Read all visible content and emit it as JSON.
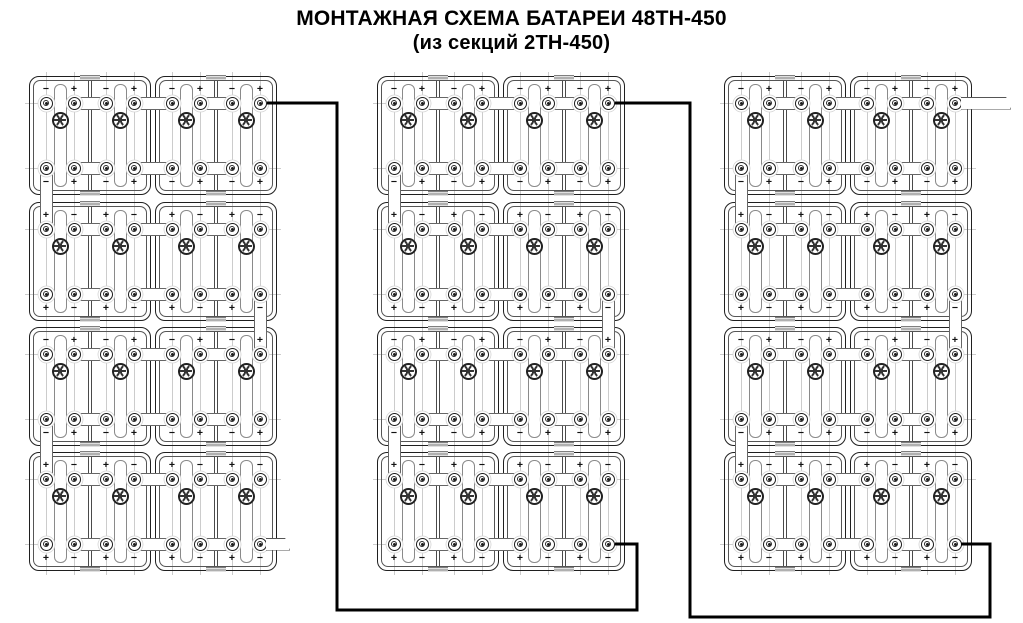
{
  "title": {
    "line1": "МОНТАЖНАЯ СХЕМА БАТАРЕИ 48ТН-450",
    "line2": "(из секций 2ТН-450)"
  },
  "battery": {
    "model": "48ТН-450",
    "section_model": "2ТН-450",
    "columns": 3,
    "rows_per_column": 4,
    "sections_per_row": 2,
    "cells_per_section": 2,
    "row_sign_patterns": [
      [
        "−",
        "+",
        "−",
        "+"
      ],
      [
        "+",
        "−",
        "+",
        "−"
      ],
      [
        "−",
        "+",
        "−",
        "+"
      ],
      [
        "+",
        "−",
        "+",
        "−"
      ]
    ],
    "inter_row_strap_sides": [
      "left",
      "right",
      "left"
    ],
    "cables": [
      {
        "name": "cable-column1-to-column2",
        "points": [
          [
            267,
            103
          ],
          [
            337,
            103
          ],
          [
            337,
            610
          ],
          [
            637,
            610
          ],
          [
            637,
            544
          ],
          [
            615,
            544
          ]
        ]
      },
      {
        "name": "cable-column2-to-column3",
        "points": [
          [
            615,
            103
          ],
          [
            690,
            103
          ],
          [
            690,
            617
          ],
          [
            990,
            617
          ],
          [
            990,
            544
          ],
          [
            961,
            544
          ]
        ]
      }
    ],
    "output_leads": [
      {
        "name": "negative-output-lead",
        "column": 1,
        "row": 4,
        "position": "bottom-right",
        "sign": "−",
        "length_px": 24
      },
      {
        "name": "positive-output-lead",
        "column": 3,
        "row": 1,
        "position": "top-right",
        "sign": "+",
        "length_px": 50
      }
    ],
    "colors": {
      "line": "#1f1f1f",
      "secondary_line": "#555555",
      "faint_line": "#cccccc",
      "cable": "#000000",
      "strap_fill": "#ffffff",
      "hatch": "#7f7f7f"
    }
  }
}
